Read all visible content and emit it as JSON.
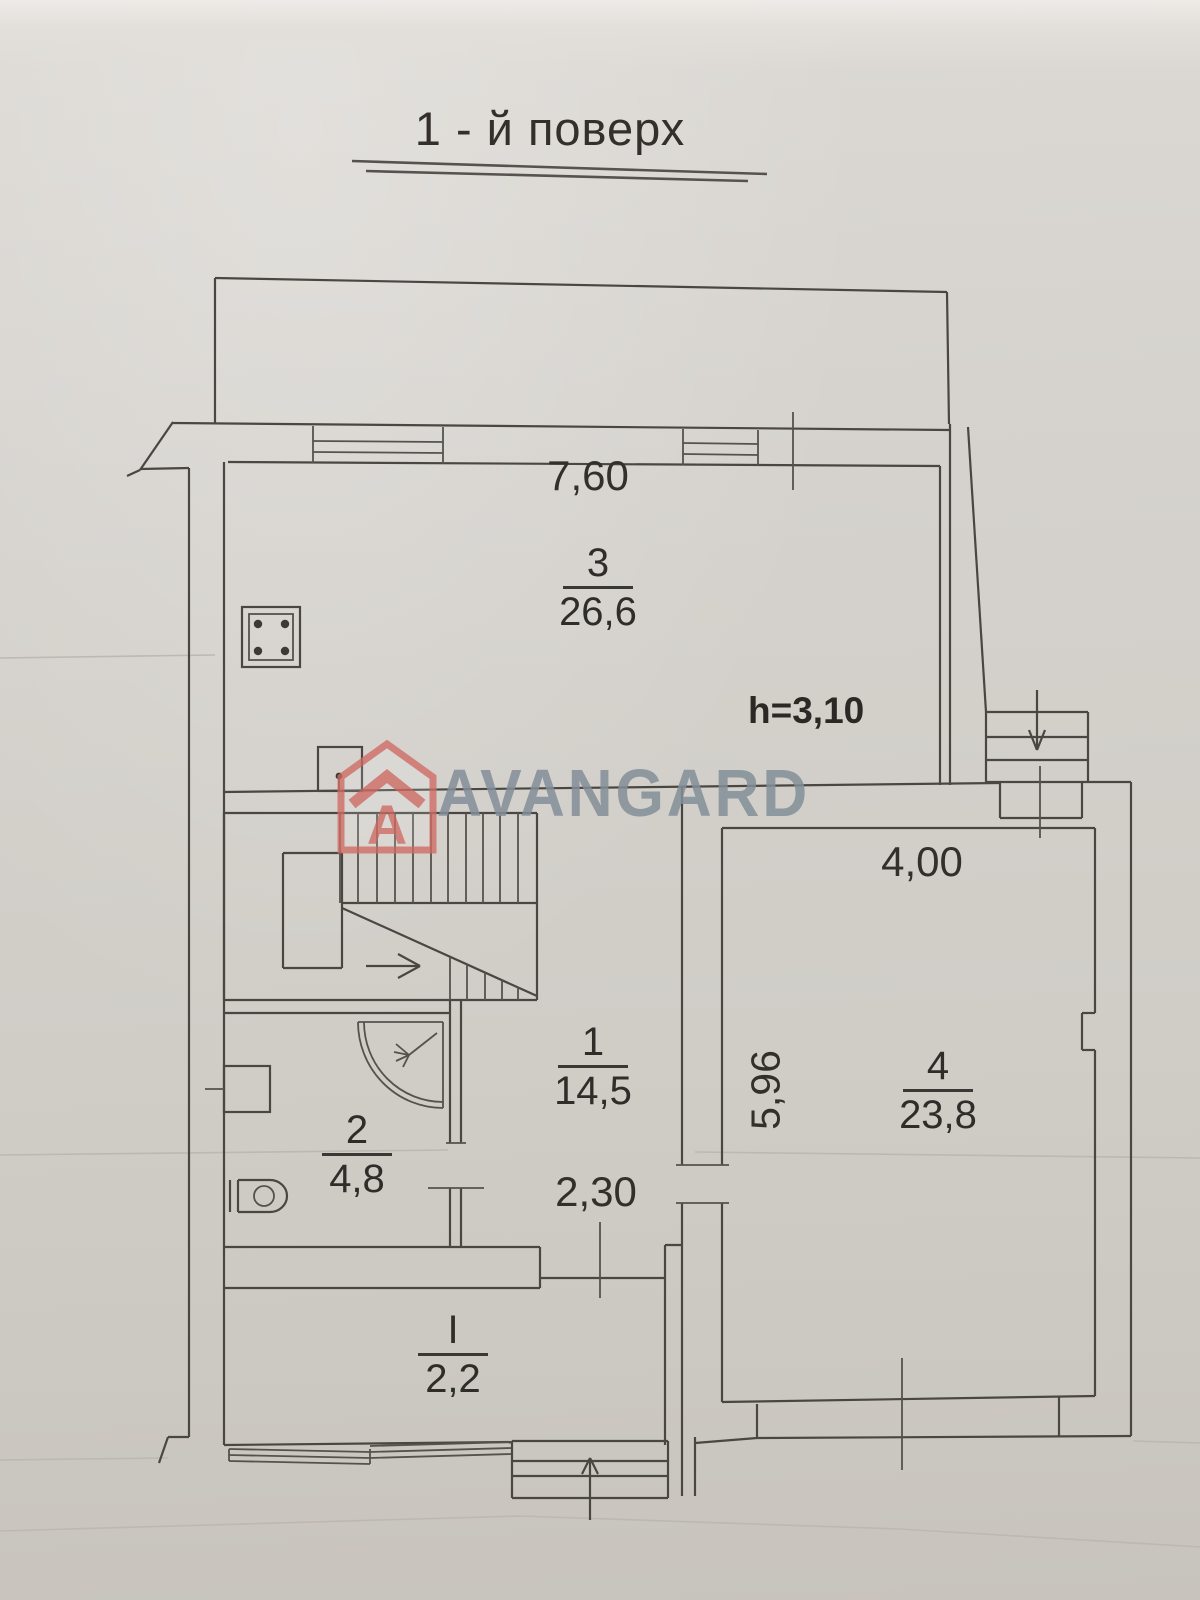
{
  "title": "1 - й поверх",
  "watermark": {
    "brand": "AVANGARD",
    "logo_letter": "A",
    "logo_color": "#cf6b64",
    "text_color": "#8d98a2"
  },
  "annotations": {
    "ceiling_height": "h=3,10"
  },
  "dimensions": {
    "room3_width": "7,60",
    "room4_width": "4,00",
    "room4_depth": "5,96",
    "hall_width": "2,30"
  },
  "rooms": [
    {
      "number": "3",
      "area": "26,6"
    },
    {
      "number": "1",
      "area": "14,5"
    },
    {
      "number": "2",
      "area": "4,8"
    },
    {
      "number": "4",
      "area": "23,8"
    },
    {
      "number": "I",
      "area": "2,2"
    }
  ]
}
